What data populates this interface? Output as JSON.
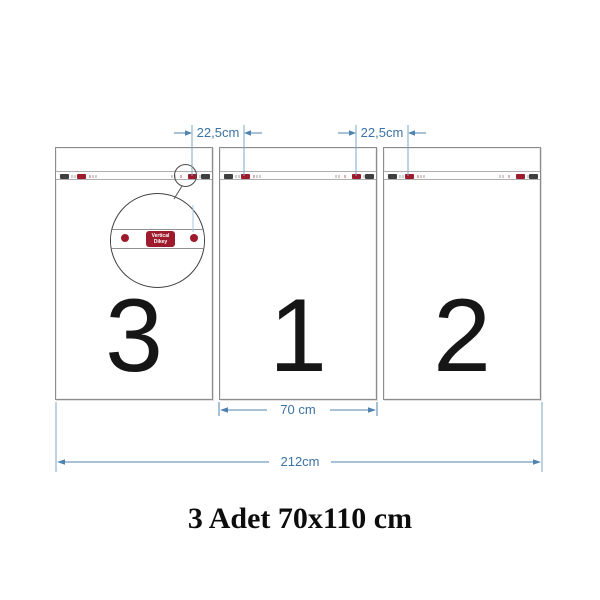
{
  "diagram": {
    "title": "3 Adet 70x110 cm",
    "panels": [
      {
        "number": "3"
      },
      {
        "number": "1"
      },
      {
        "number": "2"
      }
    ],
    "dimensions": {
      "gap_left": "22,5cm",
      "gap_right": "22,5cm",
      "panel_width": "70 cm",
      "total_width": "212cm"
    },
    "magnifier_tag": {
      "line1": "Vertical",
      "line2": "Dikey"
    },
    "colors": {
      "dimension_blue": "#4f83b0",
      "hanger_red": "#9e1b2e",
      "clip_dark": "#3f3f3f",
      "panel_border": "#8c8c8c"
    }
  }
}
